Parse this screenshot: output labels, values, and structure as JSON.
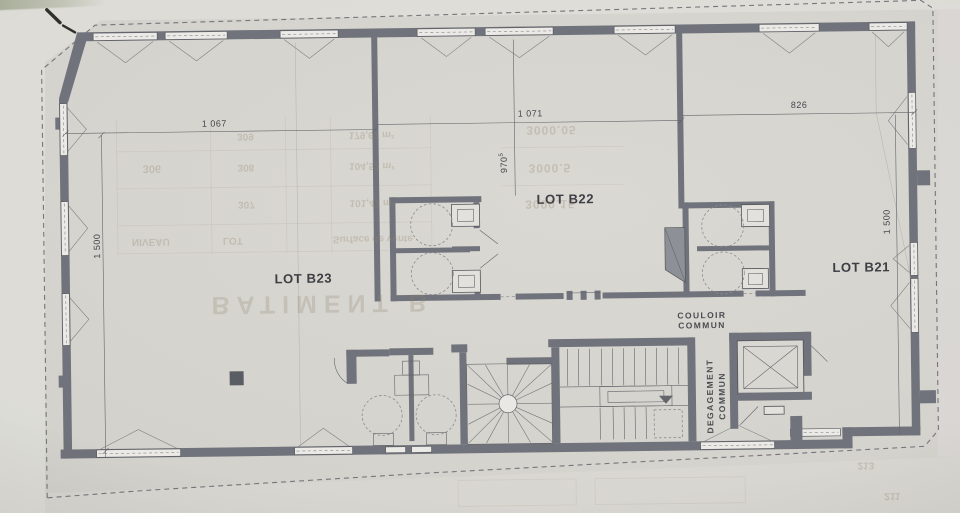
{
  "labels": {
    "lot_b23": "LOT B23",
    "lot_b22": "LOT B22",
    "lot_b21": "LOT B21",
    "couloir_l1": "COULOIR",
    "couloir_l2": "COMMUN",
    "degagement_l1": "DEGAGEMENT",
    "degagement_l2": "COMMUN",
    "dim_top_left": "1 067",
    "dim_top_mid": "1 071",
    "dim_top_right": "826",
    "dim_left": "1 500",
    "dim_right": "1 500",
    "dim_mid": "970",
    "dim_mid_sup": "5"
  },
  "bleed": {
    "items": [
      "BATIMENT B",
      "309",
      "179,67 m²",
      "306",
      "308",
      "104,52 m²",
      "307",
      "101,47 m²",
      "NIVEAU",
      "LOT",
      "Surface de vente",
      "3000.05",
      "3000.5",
      "3000.15",
      "213",
      "211"
    ]
  },
  "colors": {
    "paper": "#d6d4ce",
    "wall": "#70737b",
    "line": "#55575c",
    "label_text": "#3c3e44",
    "window_fill": "#eceae6",
    "bleedthrough": "#8f8672"
  }
}
